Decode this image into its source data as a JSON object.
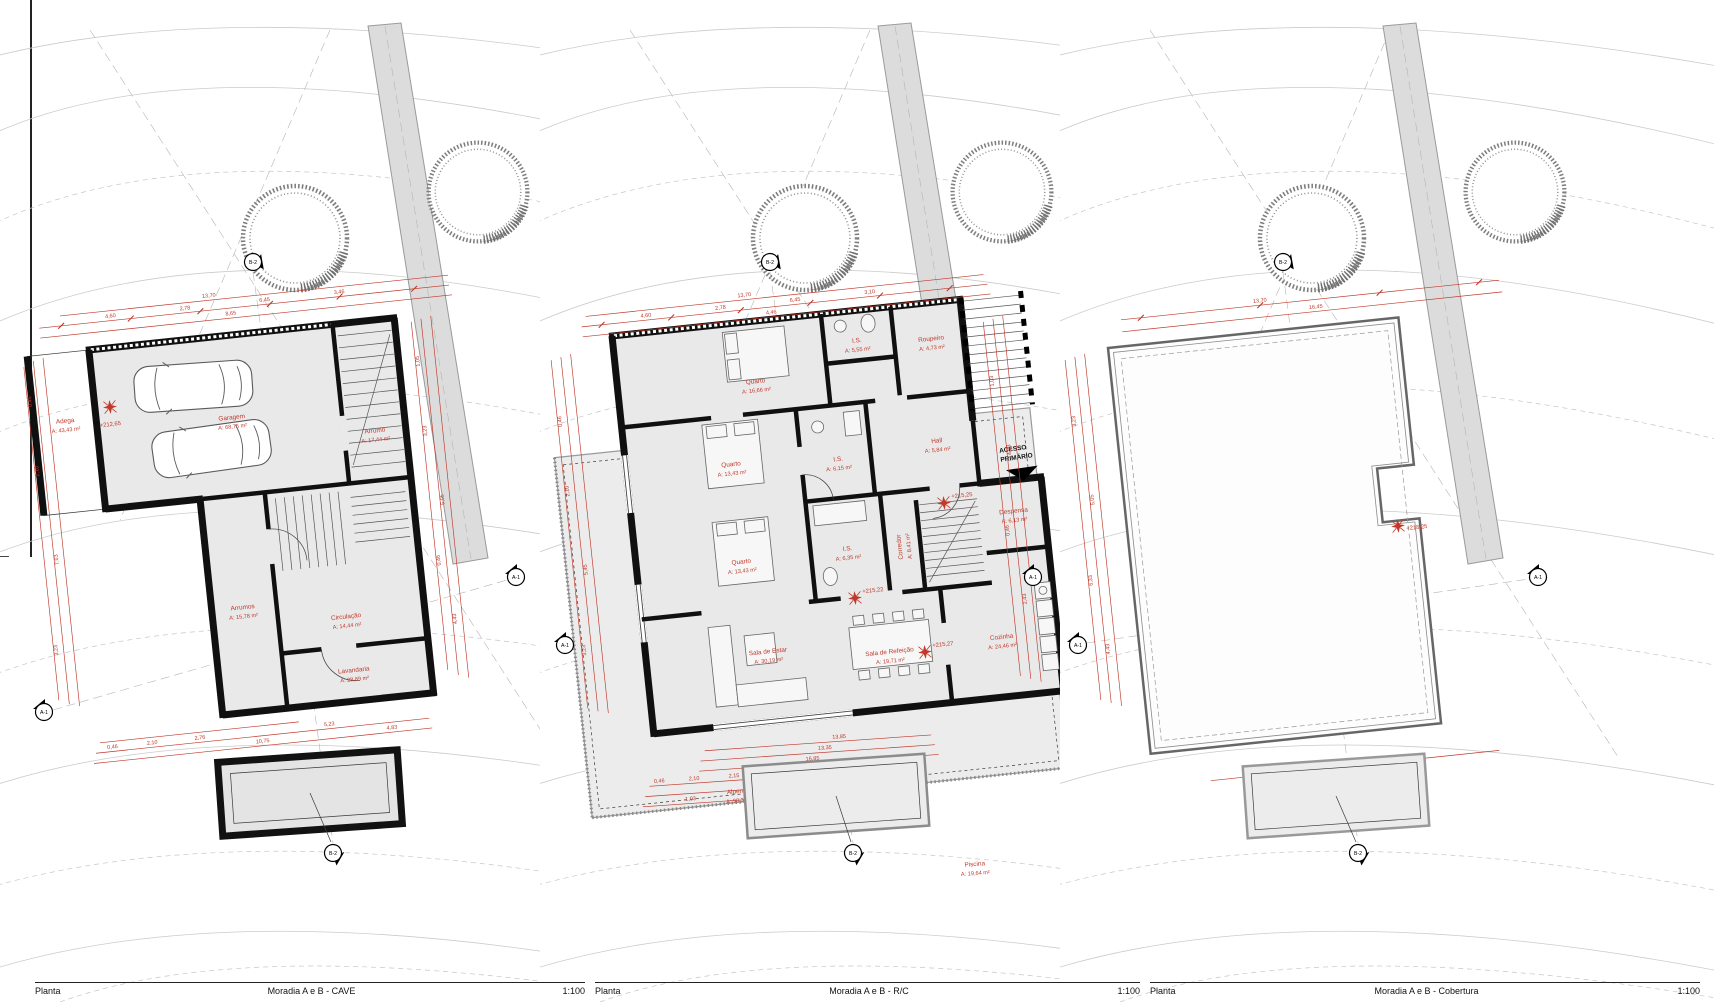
{
  "titles": [
    {
      "kind": "Planta",
      "name": "Moradia A e B - CAVE",
      "scale": "1:100"
    },
    {
      "kind": "Planta",
      "name": "Moradia A e B - R/C",
      "scale": "1:100"
    },
    {
      "kind": "Planta",
      "name": "Moradia A e B - Cobertura",
      "scale": "1:100"
    }
  ],
  "markers": {
    "side": "A-1",
    "vert": "B-2"
  },
  "plans": [
    {
      "id": "cave",
      "rooms": {
        "adega": {
          "n": "Adega",
          "a": "A: 43,43 m²"
        },
        "garagem": {
          "n": "Garagem",
          "a": "A: 68,75 m²"
        },
        "arrumo": {
          "n": "Arrumo",
          "a": "A: 17,44 m²"
        },
        "arrumos": {
          "n": "Arrumos",
          "a": "A: 15,78 m²"
        },
        "circulacao": {
          "n": "Circulação",
          "a": "A: 14,44 m²"
        },
        "lavandaria": {
          "n": "Lavandaria",
          "a": "A: 28,89 m²"
        }
      },
      "level": "+212,65",
      "dims": {
        "top": [
          "13,70",
          "4,60",
          "2,78",
          "6,45",
          "8,65",
          "3,46"
        ],
        "left": [
          "0,46",
          "2,10",
          "7,63",
          "3,23"
        ],
        "right": [
          "1,05",
          "3,23",
          "5,05",
          "0,46",
          "4,43"
        ],
        "bottom": [
          "0,46",
          "2,10",
          "2,76",
          "10,75",
          "5,23",
          "4,83"
        ]
      }
    },
    {
      "id": "rc",
      "rooms": {
        "quarto1": {
          "n": "Quarto",
          "a": "A: 16,66 m²"
        },
        "is1": {
          "n": "I.S.",
          "a": "A: 5,55 m²"
        },
        "roupeiro": {
          "n": "Roupeiro",
          "a": "A: 4,73 m²"
        },
        "quarto2": {
          "n": "Quarto",
          "a": "A: 13,43 m²"
        },
        "is2": {
          "n": "I.S.",
          "a": "A: 6,15 m²"
        },
        "quarto3": {
          "n": "Quarto",
          "a": "A: 13,43 m²"
        },
        "is3": {
          "n": "I.S.",
          "a": "A: 6,35 m²"
        },
        "corredor": {
          "n": "Corredor",
          "a": "A: 8,41 m²"
        },
        "hall": {
          "n": "Hall",
          "a": "A: 5,84 m²"
        },
        "despensa": {
          "n": "Despensa",
          "a": "A: 6,13 m²"
        },
        "cozinha": {
          "n": "Cozinha",
          "a": "A: 24,46 m²"
        },
        "salaestar": {
          "n": "Sala de Estar",
          "a": "A: 30,19 m²"
        },
        "salarefeicao": {
          "n": "Sala de Refeição",
          "a": "A: 19,71 m²"
        },
        "alpendre": {
          "n": "Alpendre",
          "a": "A: 98,39 m²"
        },
        "piscina": {
          "n": "Piscina",
          "a": "A: 19,64 m²"
        }
      },
      "levels": [
        "+215,25",
        "+215,27",
        "+215,22"
      ],
      "acesso": {
        "l1": "ACESSO",
        "l2": "PRIMÁRIO"
      },
      "dims": {
        "top": [
          "13,70",
          "4,60",
          "2,78",
          "6,45",
          "3,10",
          "4,46"
        ],
        "left": [
          "0,46",
          "2,10",
          "5,45",
          "3,23"
        ],
        "right": [
          "1,03",
          "4,03",
          "0,46",
          "2,43"
        ],
        "pool": [
          "13,85",
          "13,35",
          "16,85",
          "8,15"
        ],
        "bottom": [
          "0,46",
          "2,10",
          "2,15",
          "3,10",
          "4,45",
          "1,03"
        ]
      }
    },
    {
      "id": "cobertura",
      "level": "+218,25",
      "dims": {
        "top": [
          "13,70",
          "16,45"
        ],
        "left": [
          "3,23",
          "5,05",
          "6,33",
          "4,43"
        ],
        "bottom": [
          "40,65"
        ]
      }
    }
  ]
}
